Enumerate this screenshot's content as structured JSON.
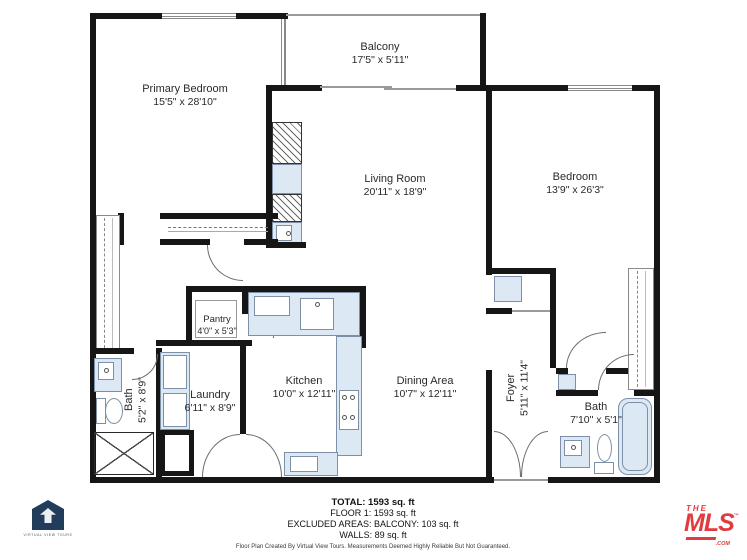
{
  "colors": {
    "wall": "#161616",
    "fixture_fill": "#dce9f5",
    "fixture_border": "#7e90a5",
    "mls_red": "#e23b3f",
    "logo_navy": "#223c5c"
  },
  "rooms": {
    "primary_bedroom": {
      "name": "Primary Bedroom",
      "dims": "15'5\" x 28'10\""
    },
    "balcony": {
      "name": "Balcony",
      "dims": "17'5\" x 5'11\""
    },
    "living_room": {
      "name": "Living Room",
      "dims": "20'11\" x 18'9\""
    },
    "bedroom": {
      "name": "Bedroom",
      "dims": "13'9\" x 26'3\""
    },
    "pantry": {
      "name": "Pantry",
      "dims": "4'0\" x 5'3\""
    },
    "kitchen": {
      "name": "Kitchen",
      "dims": "10'0\" x 12'11\""
    },
    "dining_area": {
      "name": "Dining Area",
      "dims": "10'7\" x 12'11\""
    },
    "laundry": {
      "name": "Laundry",
      "dims": "6'11\" x 8'9\""
    },
    "bath_left": {
      "name": "Bath",
      "dims": "5'2\" x 8'9\""
    },
    "foyer": {
      "name": "Foyer",
      "dims": "5'11\" x 11'4\""
    },
    "bath_right": {
      "name": "Bath",
      "dims": "7'10\" x 5'1\""
    }
  },
  "summary": {
    "total": "TOTAL: 1593 sq. ft",
    "floor": "FLOOR 1: 1593 sq. ft",
    "excluded": "EXCLUDED AREAS: BALCONY: 103 sq. ft",
    "walls": "WALLS: 89 sq. ft"
  },
  "footer": {
    "credit": "Floor Plan Created By Virtual View Tours. Measurements Deemed Highly Reliable But Not Guaranteed."
  },
  "logos": {
    "virtual_view_tours": "VIRTUAL VIEW TOURS",
    "mls_the": "THE",
    "mls_main": "MLS",
    "mls_tm": "™",
    "mls_com": ".COM"
  }
}
